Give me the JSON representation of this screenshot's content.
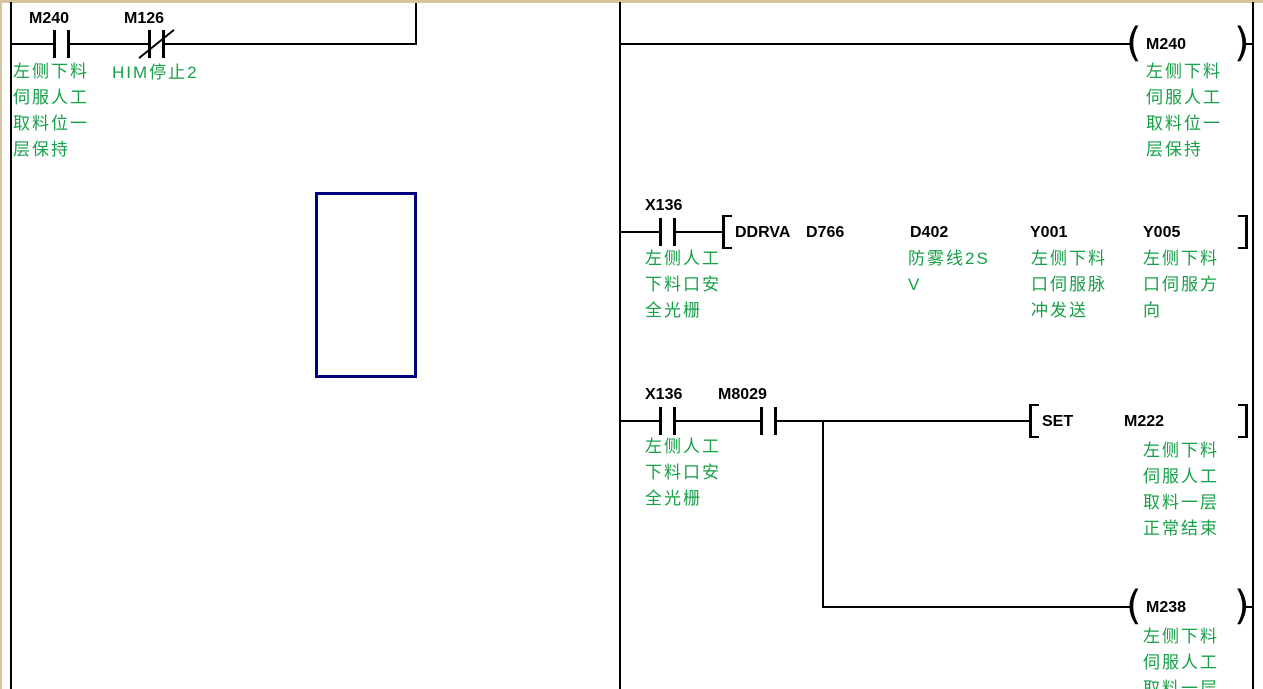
{
  "ladder": {
    "left_pane": {
      "m240": {
        "label": "M240",
        "comment": "左侧下料\n伺服人工\n取料位一\n层保持"
      },
      "m126": {
        "label": "M126",
        "comment": "HIM停止2"
      }
    },
    "right_pane": {
      "rung1_coil": {
        "label": "M240",
        "comment": "左侧下料\n伺服人工\n取料位一\n层保持"
      },
      "rung2_contact": {
        "label": "X136",
        "comment": "左侧人工\n下料口安\n全光栅"
      },
      "rung2_instruction": {
        "opcode": "DDRVA",
        "operand1": {
          "label": "D766",
          "comment": ""
        },
        "operand2": {
          "label": "D402",
          "comment": "防雾线2S\nV"
        },
        "operand3": {
          "label": "Y001",
          "comment": "左侧下料\n口伺服脉\n冲发送"
        },
        "operand4": {
          "label": "Y005",
          "comment": "左侧下料\n口伺服方\n向"
        }
      },
      "rung3_contact1": {
        "label": "X136",
        "comment": "左侧人工\n下料口安\n全光栅"
      },
      "rung3_contact2": {
        "label": "M8029",
        "comment": ""
      },
      "rung3_instruction": {
        "opcode": "SET",
        "operand": {
          "label": "M222",
          "comment": "左侧下料\n伺服人工\n取料一层\n正常结束"
        }
      },
      "rung3_branch_coil": {
        "label": "M238",
        "comment": "左侧下料\n伺服人工\n取料一层"
      }
    }
  },
  "colors": {
    "comment_green": "#16a047",
    "selection_blue": "#000080",
    "frame_beige": "#d5c59a",
    "wire_black": "#000000"
  }
}
